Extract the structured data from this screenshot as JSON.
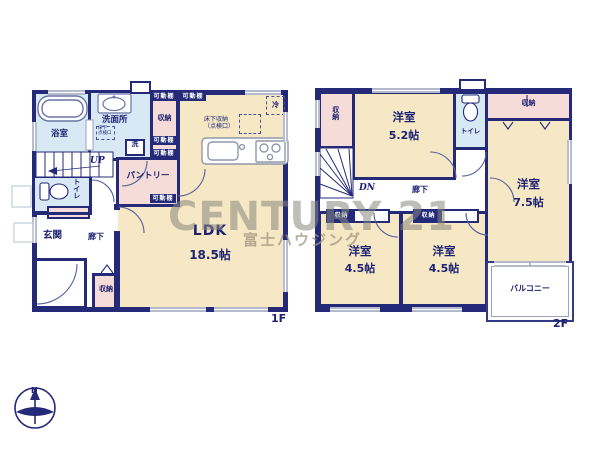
{
  "colors": {
    "wall": "#242a78",
    "room_cream": "#f6e8c4",
    "wet_blue": "#d8e9f5",
    "storage_pink": "#f6dcd8",
    "line_gray": "#98a2bb",
    "watermark_gray": "#868680"
  },
  "watermark": {
    "brand": "CENTURY 21",
    "company": "富士ハウジング"
  },
  "compass": {
    "north": "N"
  },
  "f1": {
    "floor_label": "1F",
    "ldk": {
      "name": "LDK",
      "size": "18.5帖"
    },
    "bathroom": "浴室",
    "washroom": "洗面所",
    "washer": "洗",
    "underfloor_access": {
      "l1": "床下",
      "l2": "点検口"
    },
    "underfloor_storage": {
      "l1": "床下収納",
      "l2": "（点検口）"
    },
    "fridge": "冷",
    "shelf_tag": "可動棚",
    "storage_top": "収納",
    "pantry": "パントリー",
    "stairs": "UP",
    "toilet": "トイレ",
    "entrance": "玄関",
    "hallway": "廊下",
    "storage_bottom": "収納"
  },
  "f2": {
    "floor_label": "2F",
    "storage_left": "収納",
    "stairs": "DN",
    "hallway": "廊下",
    "toilet": "トイレ",
    "storage_top": "収納",
    "closet_tag": "収納",
    "room_52": {
      "name": "洋室",
      "size": "5.2帖"
    },
    "room_75": {
      "name": "洋室",
      "size": "7.5帖"
    },
    "room_45a": {
      "name": "洋室",
      "size": "4.5帖"
    },
    "room_45b": {
      "name": "洋室",
      "size": "4.5帖"
    },
    "balcony": "バルコニー"
  }
}
